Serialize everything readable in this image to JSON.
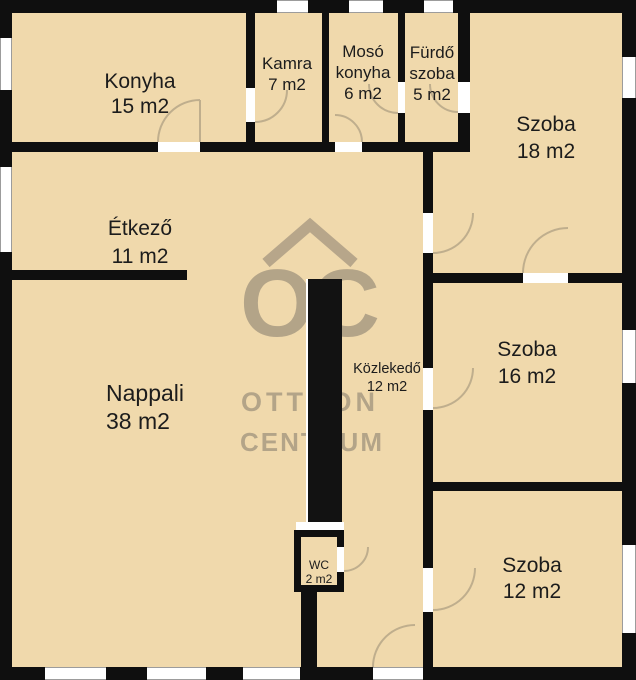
{
  "plan_title": "apartment-floor-plan",
  "colors": {
    "floor": "#f0d9ac",
    "wall": "#0f0f0f",
    "arc": "#bfae8d",
    "watermark": "#7d7468",
    "label": "#1c1c1c"
  },
  "watermark": {
    "monogram": "OC",
    "line1": "OTTHON",
    "line2": "CENTRUM"
  },
  "rooms": [
    {
      "name": "Konyha",
      "area": "15 m2"
    },
    {
      "name": "Kamra",
      "area": "7 m2"
    },
    {
      "name": "Mosó\nkonyha",
      "area": "6 m2"
    },
    {
      "name": "Fürdő\nszoba",
      "area": "5 m2"
    },
    {
      "name": "Szoba",
      "area": "18 m2"
    },
    {
      "name": "Étkező",
      "area": "11 m2"
    },
    {
      "name": "Nappali",
      "area": "38 m2"
    },
    {
      "name": "Közlekedő",
      "area": "12 m2"
    },
    {
      "name": "Szoba",
      "area": "16 m2"
    },
    {
      "name": "WC",
      "area": "2 m2"
    },
    {
      "name": "Szoba",
      "area": "12 m2"
    }
  ]
}
